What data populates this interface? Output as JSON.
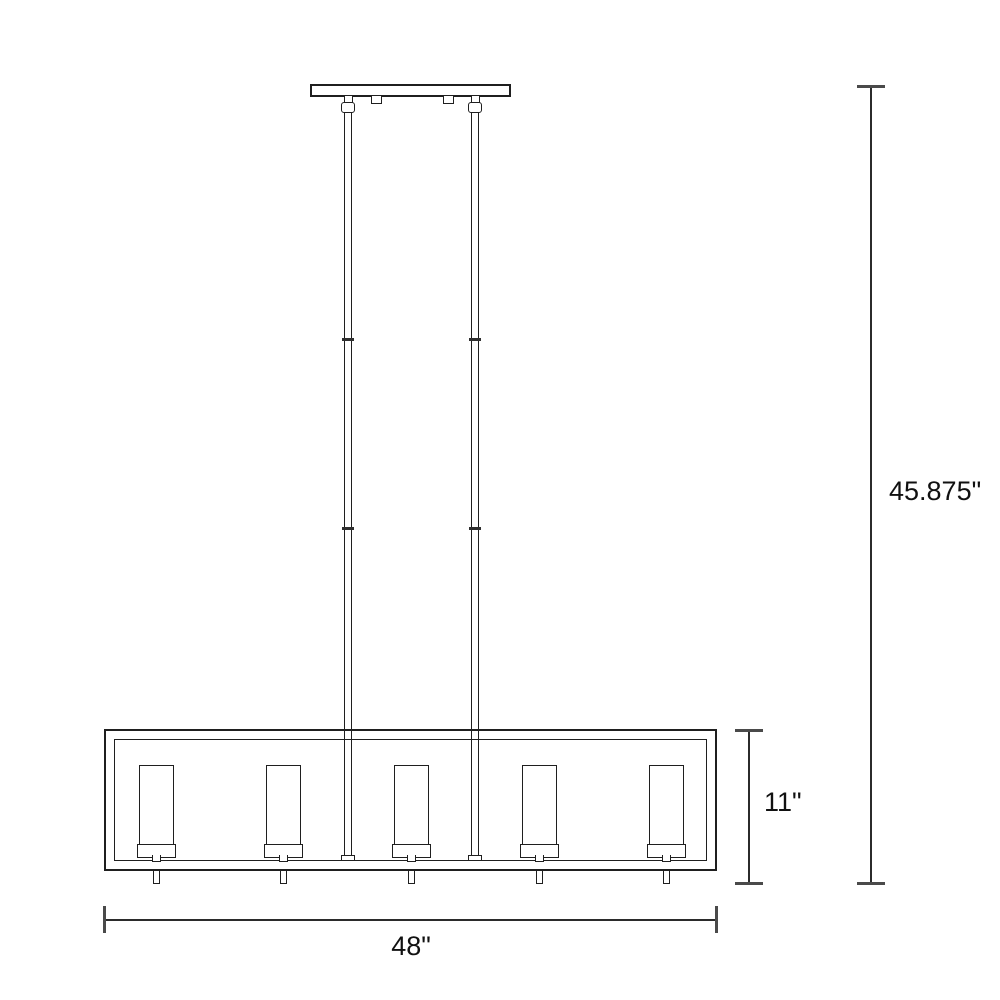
{
  "drawing": {
    "type": "product-dimension-line-drawing",
    "light_count": 5,
    "colors": {
      "background": "#ffffff",
      "line": "#1f1f1f",
      "dimension_line": "#2b2b2b",
      "text": "#111111"
    },
    "dimensions": {
      "overall_height_label": "45.875\"",
      "body_height_label": "11\"",
      "body_width_label": "48\""
    }
  }
}
